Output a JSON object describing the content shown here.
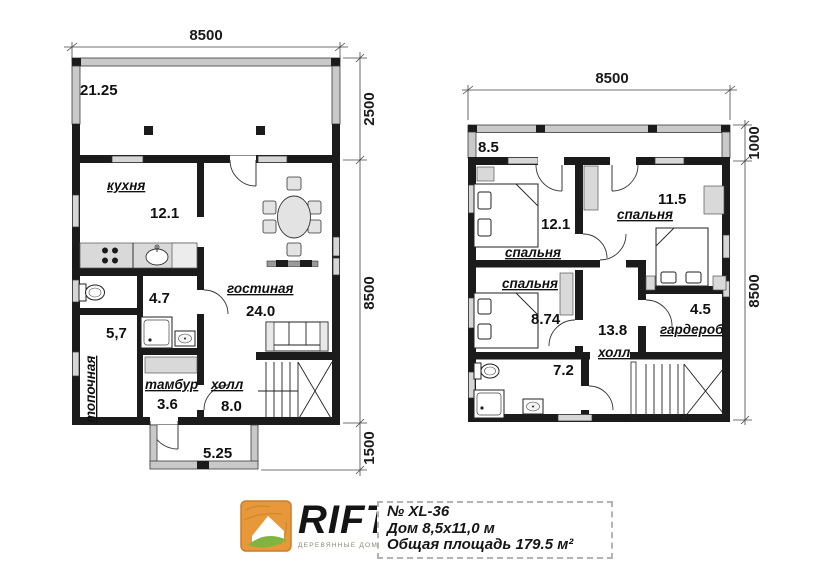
{
  "colors": {
    "wall": "#1b1b1b",
    "window_fill": "#d6d6d6",
    "terrace_wall": "#c9c9c9",
    "logo_orange": "#e8983a",
    "logo_green": "#7fb441",
    "text": "#1a1a1a"
  },
  "first_floor": {
    "dim_width": "8500",
    "dim_terrace_depth": "2500",
    "dim_main_depth": "8500",
    "dim_porch_depth": "1500",
    "terrace_area": "21.25",
    "kitchen": {
      "name": "кухня",
      "area": "12.1"
    },
    "living": {
      "name": "гостиная",
      "area": "24.0"
    },
    "bathroom_area": "4.7",
    "boiler": {
      "name": "топочная",
      "area": "5,7"
    },
    "tambour": {
      "name": "тамбур",
      "area": "3.6"
    },
    "hall": {
      "name": "холл",
      "area": "8.0"
    },
    "porch_area": "5.25"
  },
  "second_floor": {
    "dim_width": "8500",
    "dim_balcony_depth": "1000",
    "dim_main_depth": "8500",
    "balcony_area": "8.5",
    "bedroom1": {
      "name": "спальня",
      "area": "12.1"
    },
    "bedroom2": {
      "name": "спальня",
      "area": "11.5"
    },
    "bedroom3": {
      "name": "спальня",
      "area": "8.74"
    },
    "wardrobe": {
      "name": "гардероб",
      "area": "4.5"
    },
    "hall": {
      "name": "холл",
      "area": "13.8"
    },
    "bathroom_area": "7.2"
  },
  "footer": {
    "logo_text": "RIFT",
    "logo_tagline": "ДЕРЕВЯННЫЕ ДОМА И БАНИ",
    "project_number": "№ XL-36",
    "house_size": "Дом 8,5x11,0 м",
    "total_area": "Общая площадь 179.5 м²"
  }
}
